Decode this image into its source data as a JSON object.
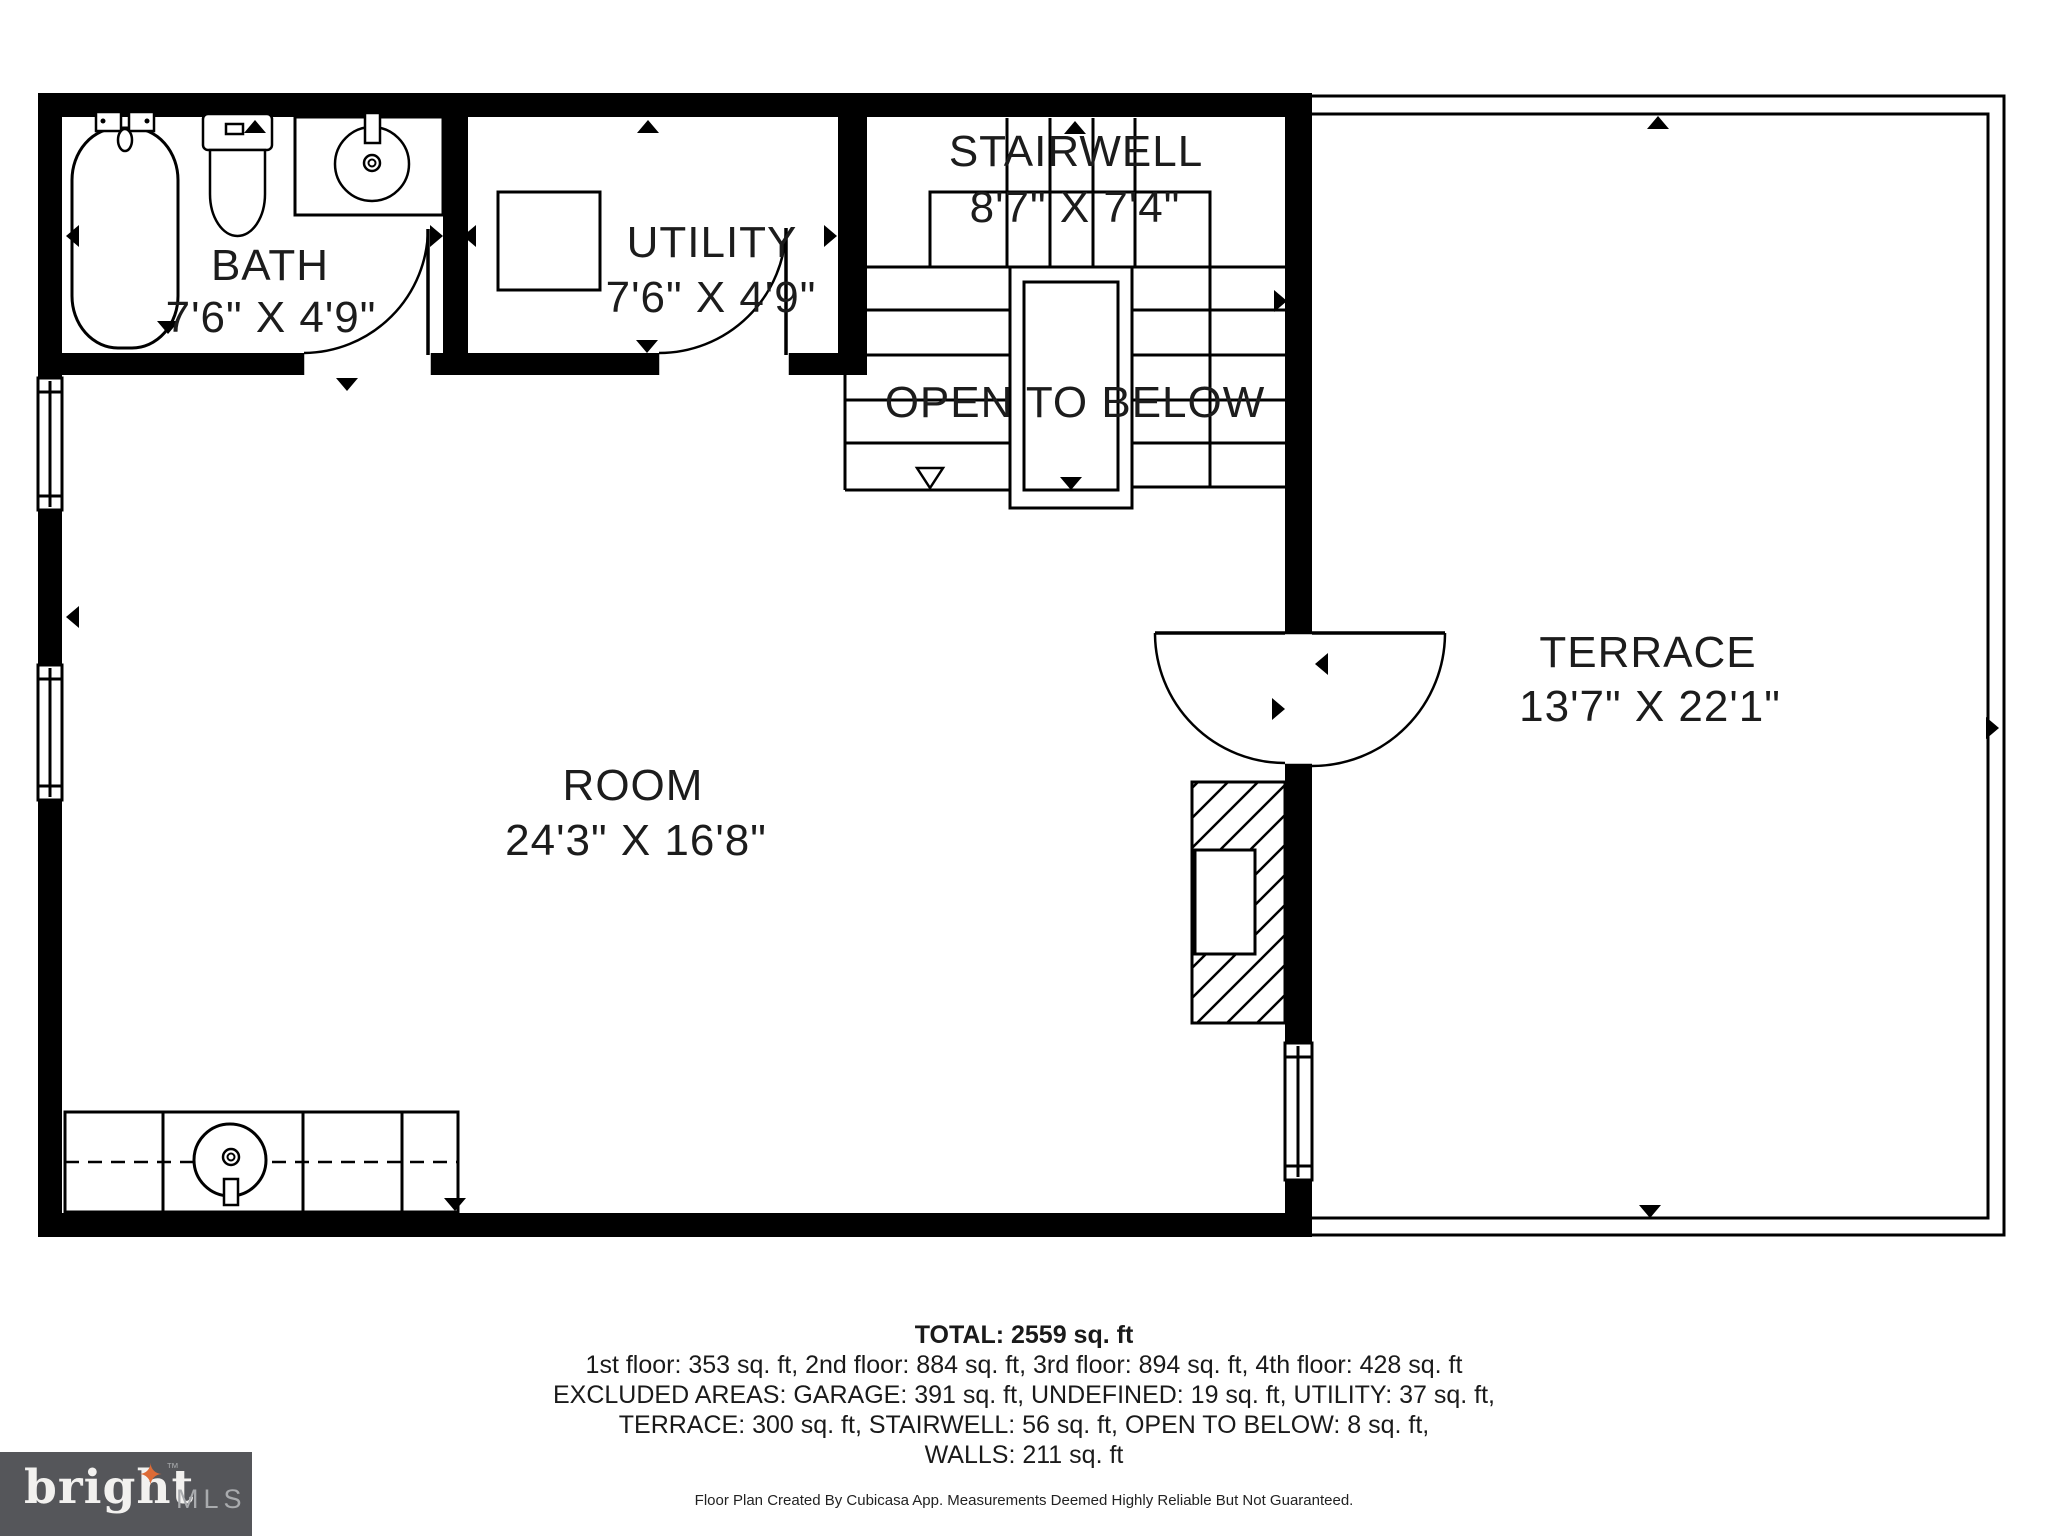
{
  "floor_plan": {
    "rooms": [
      {
        "name": "BATH",
        "dimensions": "7'6\" X 4'9\""
      },
      {
        "name": "UTILITY",
        "dimensions": "7'6\" X 4'9\""
      },
      {
        "name": "STAIRWELL",
        "dimensions": "8'7\" X 7'4\""
      },
      {
        "name": "ROOM",
        "dimensions": "24'3\" X 16'8\""
      },
      {
        "name": "TERRACE",
        "dimensions": "13'7\" X 22'1\""
      }
    ],
    "open_to_below_label": "OPEN TO BELOW"
  },
  "summary": {
    "total": "TOTAL: 2559 sq. ft",
    "floors_line": "1st floor: 353 sq. ft, 2nd floor: 884 sq. ft, 3rd floor: 894 sq. ft, 4th floor: 428 sq. ft",
    "excluded_line1": "EXCLUDED AREAS: GARAGE: 391 sq. ft, UNDEFINED: 19 sq. ft, UTILITY: 37 sq. ft,",
    "excluded_line2": "TERRACE: 300 sq. ft, STAIRWELL: 56 sq. ft, OPEN TO BELOW: 8 sq. ft,",
    "walls_line": "WALLS: 211 sq. ft",
    "disclaimer": "Floor Plan Created By Cubicasa App. Measurements Deemed Highly Reliable But Not Guaranteed."
  },
  "branding": {
    "name": "bright",
    "tm": "™",
    "suffix": "MLS",
    "star_glyph": "✦",
    "box_color": "#55565A",
    "star_color": "#DD6B36"
  },
  "colors": {
    "wall": "#000000",
    "line": "#000000",
    "label": "#1C1C1C",
    "background": "#FFFFFF"
  }
}
